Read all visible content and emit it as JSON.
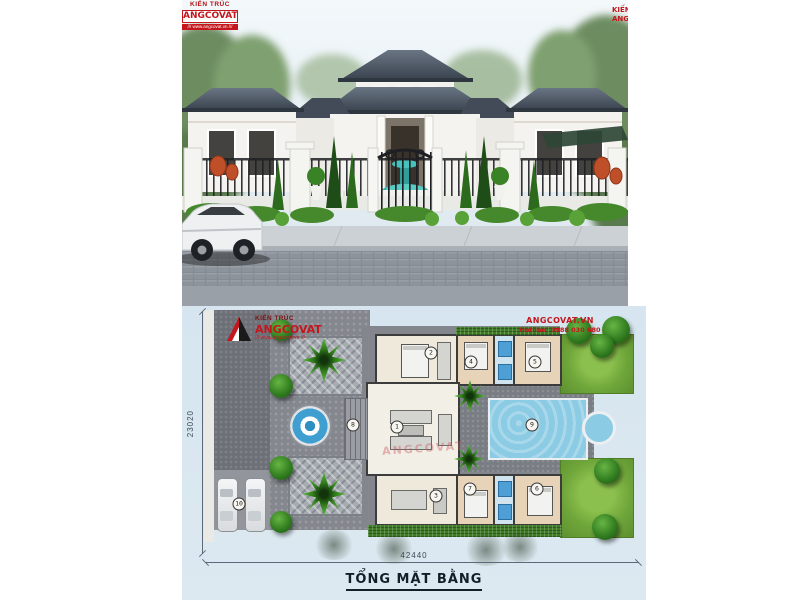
{
  "colors": {
    "accent_red": "#c4161c",
    "panel_blue": "#d9e7f0",
    "pool_blue": "#8ccbe4",
    "roof_slate": "#47515e",
    "lawn_green": "#6fa63a"
  },
  "photo": {
    "logo": {
      "prefix": "KIẾN TRÚC",
      "name": "ANGCOVAT",
      "strip": "/// www.angcovat.vn ///"
    },
    "corner": {
      "line1": "KIẾN TRÚC",
      "line2": "ANGCOVAT"
    }
  },
  "plan": {
    "logo": {
      "prefix": "KIẾN TRÚC",
      "name": "ANGCOVAT",
      "strip": "/// www.angcovat.vn ///"
    },
    "contact": {
      "line1": "ANGCOVAT.VN",
      "line2": "Hotline: 0988 030 680"
    },
    "watermark": "ANGCOVAT",
    "dimensions": {
      "width": "42440",
      "height": "23020"
    },
    "title": "TỔNG MẶT BẰNG",
    "markers": [
      {
        "label": "1",
        "x": 215,
        "y": 121
      },
      {
        "label": "2",
        "x": 249,
        "y": 47
      },
      {
        "label": "3",
        "x": 254,
        "y": 190
      },
      {
        "label": "4",
        "x": 289,
        "y": 56
      },
      {
        "label": "5",
        "x": 353,
        "y": 56
      },
      {
        "label": "6",
        "x": 355,
        "y": 183
      },
      {
        "label": "7",
        "x": 288,
        "y": 183
      },
      {
        "label": "8",
        "x": 171,
        "y": 119
      },
      {
        "label": "9",
        "x": 350,
        "y": 119
      },
      {
        "label": "10",
        "x": 57,
        "y": 198
      }
    ]
  }
}
